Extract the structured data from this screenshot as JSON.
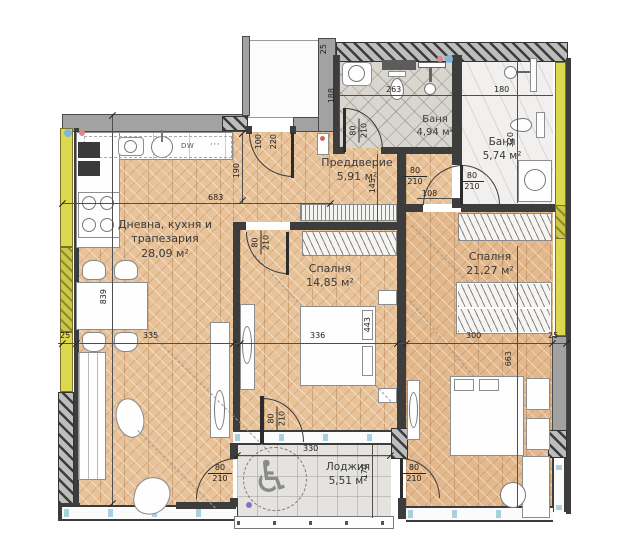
{
  "rooms": [
    {
      "name": "Дневна, кухня и",
      "name2": "трапезария",
      "area": "28,09 м²"
    },
    {
      "name": "Спалня",
      "area": "14,85 м²"
    },
    {
      "name": "Спалня",
      "area": "21,27 м²"
    },
    {
      "name": "Баня",
      "area": "4,94 м²"
    },
    {
      "name": "Баня",
      "area": "5,74 м²"
    },
    {
      "name": "Преддверие",
      "area": "5,91 м²"
    },
    {
      "name": "Лоджия",
      "area": "5,51 м²"
    }
  ],
  "kitchen": {
    "dishwasher_label": "DW",
    "dots_label": "···"
  },
  "accessibility_symbol": "♿",
  "colors": {
    "insulation_yellow": "#ddd84e",
    "wall_gray": "#a2a2a2",
    "parquet": "#e8c298",
    "glazing_blue": "#a9d0e2"
  },
  "dimensions": [
    {
      "t": "683",
      "x": 208,
      "y": 194
    },
    {
      "t": "190",
      "x": 233,
      "y": 163,
      "r": 1
    },
    {
      "t": "100",
      "x": 255,
      "y": 134,
      "r": 1
    },
    {
      "t": "220",
      "x": 270,
      "y": 134,
      "r": 1
    },
    {
      "t": "263",
      "x": 386,
      "y": 86
    },
    {
      "t": "188",
      "x": 328,
      "y": 88,
      "r": 1
    },
    {
      "t": "180",
      "x": 494,
      "y": 86
    },
    {
      "t": "320",
      "x": 507,
      "y": 132,
      "r": 1
    },
    {
      "t": "145",
      "x": 369,
      "y": 178,
      "r": 1
    },
    {
      "t": "108",
      "x": 422,
      "y": 190
    },
    {
      "t": "25",
      "x": 320,
      "y": 44,
      "r": 1
    },
    {
      "t": "25",
      "x": 60,
      "y": 332
    },
    {
      "t": "335",
      "x": 143,
      "y": 332
    },
    {
      "t": "336",
      "x": 310,
      "y": 332
    },
    {
      "t": "443",
      "x": 364,
      "y": 317,
      "r": 1
    },
    {
      "t": "300",
      "x": 466,
      "y": 332
    },
    {
      "t": "25",
      "x": 548,
      "y": 332
    },
    {
      "t": "839",
      "x": 100,
      "y": 289,
      "r": 1
    },
    {
      "t": "663",
      "x": 505,
      "y": 351,
      "r": 1
    },
    {
      "t": "330",
      "x": 303,
      "y": 445
    },
    {
      "t": "170",
      "x": 361,
      "y": 464,
      "r": 1
    }
  ],
  "door_labels": [
    {
      "w": "80",
      "h": "210",
      "x": 347,
      "y": 120,
      "r": 1
    },
    {
      "w": "80",
      "h": "210",
      "x": 460,
      "y": 171,
      "r": 0
    },
    {
      "w": "80",
      "h": "210",
      "x": 403,
      "y": 166,
      "r": 0
    },
    {
      "w": "80",
      "h": "210",
      "x": 249,
      "y": 232,
      "r": 1
    },
    {
      "w": "80",
      "h": "210",
      "x": 265,
      "y": 408,
      "r": 1
    },
    {
      "w": "80",
      "h": "210",
      "x": 208,
      "y": 463,
      "r": 0
    },
    {
      "w": "80",
      "h": "210",
      "x": 402,
      "y": 463,
      "r": 0
    }
  ],
  "ticks": [
    {
      "x": 62,
      "y": 343
    },
    {
      "x": 76,
      "y": 343
    },
    {
      "x": 233,
      "y": 343
    },
    {
      "x": 240,
      "y": 343
    },
    {
      "x": 397,
      "y": 343
    },
    {
      "x": 406,
      "y": 343
    },
    {
      "x": 552,
      "y": 343
    },
    {
      "x": 566,
      "y": 343
    },
    {
      "x": 62,
      "y": 203
    },
    {
      "x": 330,
      "y": 203
    },
    {
      "x": 237,
      "y": 455
    },
    {
      "x": 390,
      "y": 455
    },
    {
      "x": 112,
      "y": 115
    },
    {
      "x": 112,
      "y": 503
    },
    {
      "x": 242,
      "y": 133
    },
    {
      "x": 242,
      "y": 200
    }
  ]
}
